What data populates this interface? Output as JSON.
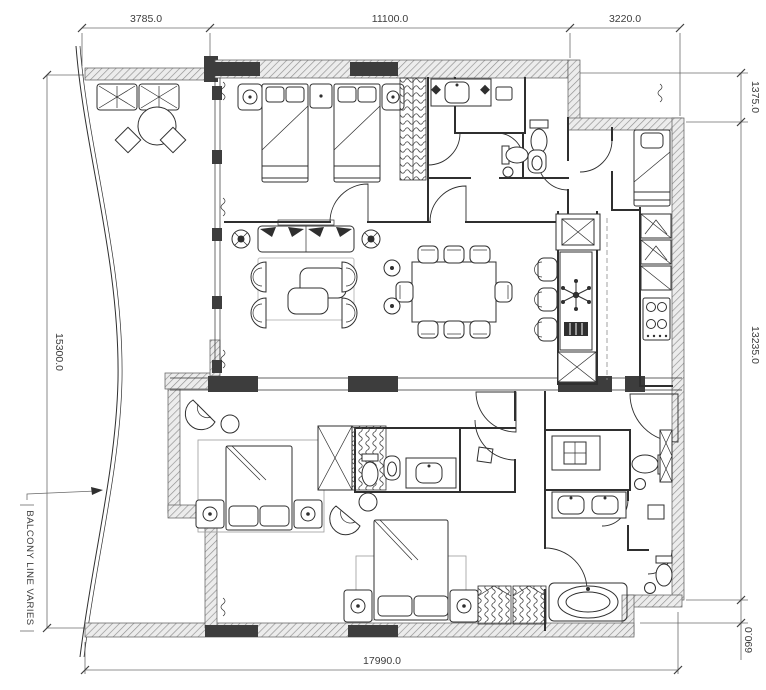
{
  "document": {
    "type": "architectural-floor-plan",
    "dimensions": {
      "top": [
        "3785.0",
        "11100.0",
        "3220.0"
      ],
      "left": [
        "15300.0"
      ],
      "right": [
        "1375.0",
        "13235.0",
        "690.0"
      ],
      "bottom": [
        "17990.0"
      ]
    },
    "notes": {
      "balcony": "BALCONY LINE VARIES"
    },
    "colors": {
      "ink": "#2f2f2f",
      "wall_fill": "#3d3d3d",
      "hatch_line": "#8f8f8f",
      "hatch_bg": "#ececec",
      "dim_line": "#6b6b6b",
      "paper": "#ffffff"
    }
  }
}
